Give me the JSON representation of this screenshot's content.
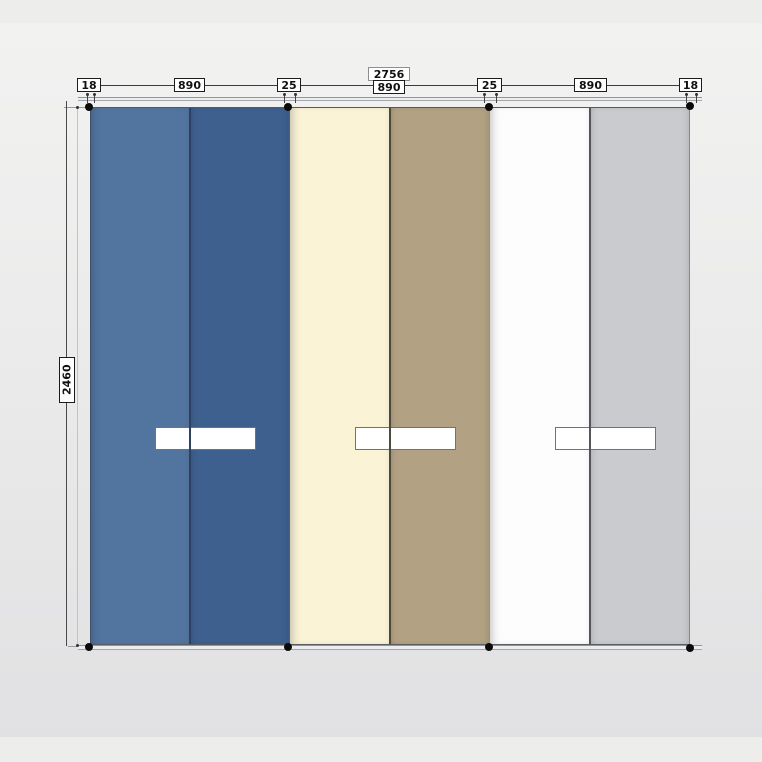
{
  "canvas": {
    "background_top": "#f2f2f1",
    "background_bottom": "#e1e1e3",
    "margin_color": "#ededec"
  },
  "dimensions": {
    "total_width_label": "2756",
    "total_height_label": "2460",
    "top_segments": [
      "18",
      "890",
      "25",
      "890",
      "25",
      "890",
      "18"
    ]
  },
  "style": {
    "label_background": "#ffffff",
    "label_border": "#1c1c1c",
    "dimension_line_color": "#3a3a3a",
    "marker_dot_color": "#0b0b0b",
    "rail_color": "#9aa0a4",
    "handle_fill": "#ffffff",
    "handle_border": "#6e737a"
  },
  "doors": [
    {
      "name": "door-1",
      "left_half_color": "#52759f",
      "right_half_color": "#3e608e",
      "separator_color": "#2e4160"
    },
    {
      "name": "door-2",
      "left_half_color": "#faf3d6",
      "right_half_color": "#b3a183",
      "separator_color": "#4b4a3f"
    },
    {
      "name": "door-3",
      "left_half_color": "#fdfdfe",
      "right_half_color": "#c9cbce",
      "separator_color": "#54565b"
    }
  ]
}
